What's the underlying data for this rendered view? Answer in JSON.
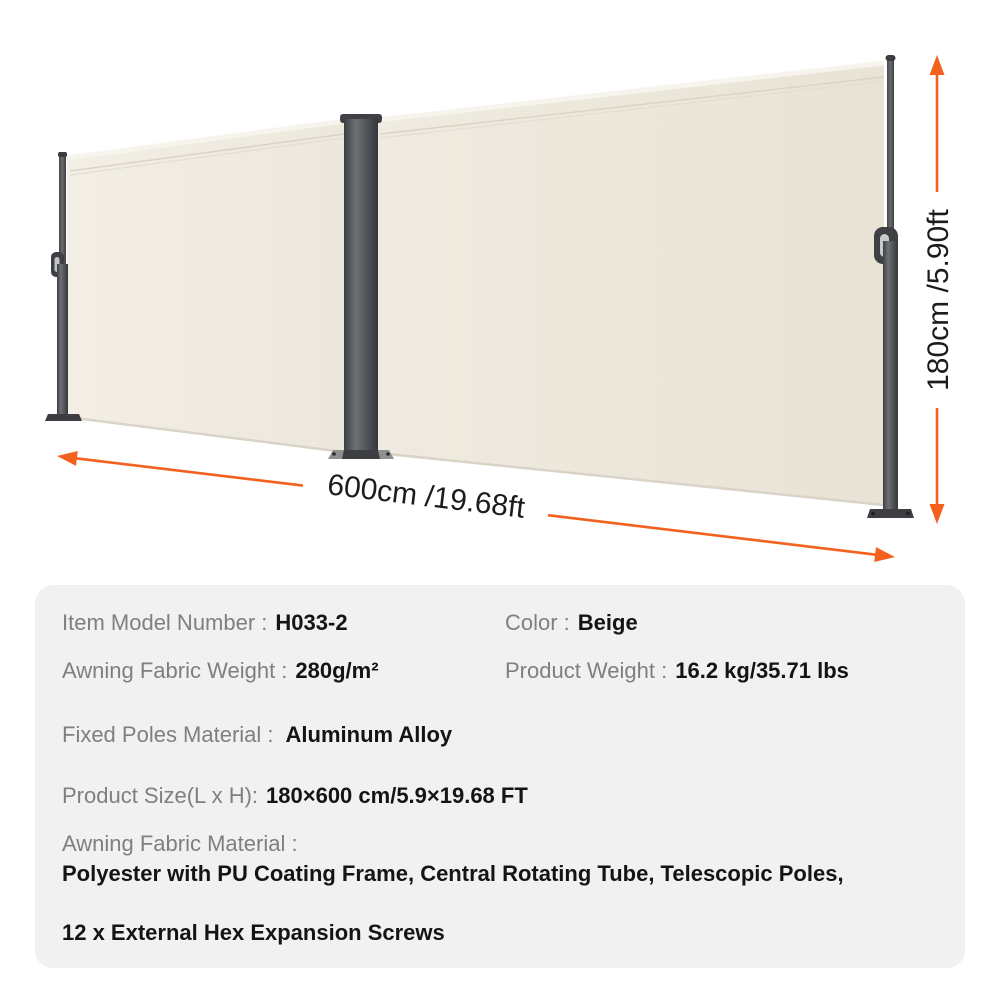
{
  "product_visual": {
    "height_dimension": "180cm /5.90ft",
    "width_dimension": "600cm /19.68ft"
  },
  "specs": {
    "item_model": {
      "label": "Item Model Number :",
      "value": "H033-2"
    },
    "color": {
      "label": "Color :",
      "value": "Beige"
    },
    "fabric_weight": {
      "label": "Awning Fabric Weight :",
      "value": "280g/m²"
    },
    "product_weight": {
      "label": "Product Weight :",
      "value": "16.2 kg/35.71 lbs"
    },
    "poles_material": {
      "label": "Fixed Poles Material :",
      "value": "Aluminum Alloy"
    },
    "product_size": {
      "label": "Product Size(L x H):",
      "value": "180×600 cm/5.9×19.68 FT"
    },
    "fabric_material": {
      "label": "Awning Fabric Material :",
      "value_line1": "Polyester with PU Coating Frame, Central Rotating Tube, Telescopic Poles,",
      "value_line2": "12 x External Hex Expansion Screws"
    }
  },
  "colors": {
    "accent_orange": "#f4611f",
    "fabric_beige": "#ebe7dc",
    "pole_gray": "#4a4c4f",
    "panel_background": "#f1f1f1"
  }
}
